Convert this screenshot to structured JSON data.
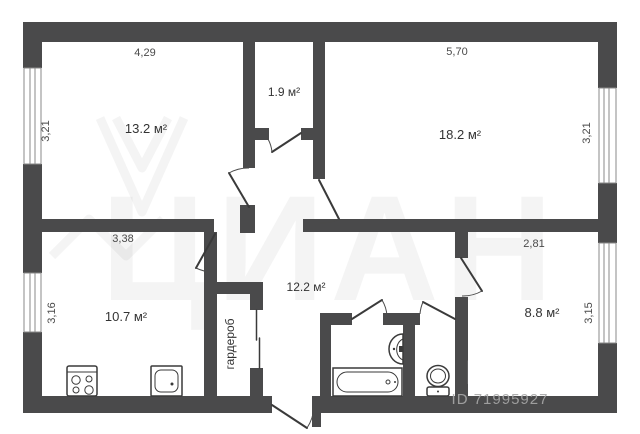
{
  "floorplan": {
    "rooms": [
      {
        "name": "room-top-left",
        "area": "13.2 м²",
        "top_dim": "4,29",
        "side_dim": "3,21"
      },
      {
        "name": "closet-top",
        "area": "1.9 м²"
      },
      {
        "name": "room-top-right",
        "area": "18.2 м²",
        "top_dim": "5,70",
        "side_dim": "3,21"
      },
      {
        "name": "kitchen",
        "area": "10.7 м²",
        "top_dim": "3,38",
        "side_dim": "3,16"
      },
      {
        "name": "hallway",
        "area": "12.2 м²"
      },
      {
        "name": "room-bottom-right",
        "area": "8.8 м²",
        "top_dim": "2,81",
        "side_dim": "3,15"
      },
      {
        "name": "wardrobe",
        "label": "гардероб"
      }
    ],
    "fixtures": [
      "stove-icon",
      "kitchen-sink-icon",
      "bathtub-icon",
      "washbasin-icon",
      "toilet-icon",
      "window-icon",
      "door-swing-icon"
    ],
    "watermark": {
      "big_text": "ЦИАН",
      "logo_text": "Циан",
      "listing_id": "ID 71995927"
    },
    "colors": {
      "wall": "#4a4a4b",
      "background": "#ffffff",
      "line": "#3a3a3a",
      "dim_text": "#4a4a4a"
    }
  }
}
